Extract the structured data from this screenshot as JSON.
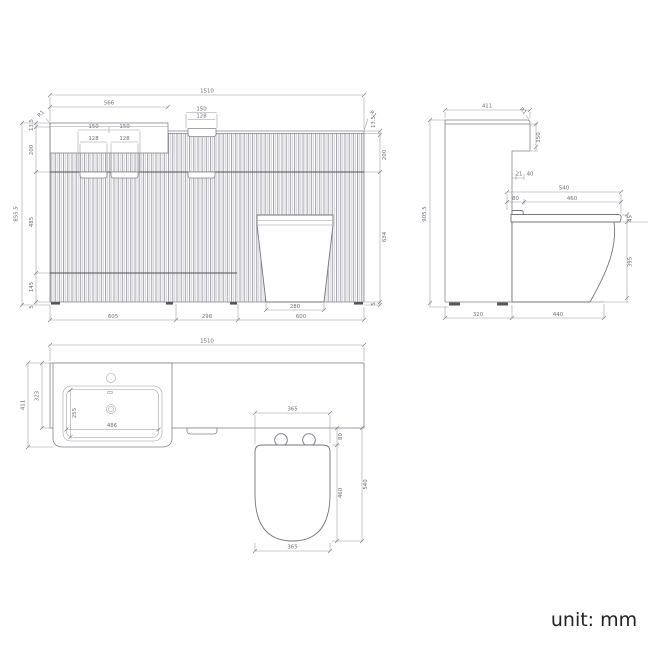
{
  "footer": {
    "unit_label": "unit: mm"
  },
  "colors": {
    "line": "#84848c",
    "dim_text": "#6e6e78",
    "unit_text": "#1f1f24",
    "background": "#ffffff"
  },
  "front": {
    "width_total": "1510",
    "basin_section_width": "566",
    "top_handle_outer": "150",
    "top_handle_inner": "128",
    "drawer_handle_left_outer": "150",
    "drawer_handle_right_outer": "150",
    "drawer_handle_left_inner": "128",
    "drawer_handle_right_inner": "128",
    "radius_left": "R1",
    "radius_right": "R1",
    "counter_thickness_left": "13.5",
    "counter_thickness_right": "13.5",
    "top_section_left": "200",
    "top_section_right": "200",
    "mid_section_left": "485",
    "lower_section_left": "145",
    "plinth_left": "5",
    "plinth_right": "5",
    "height_total": "855.5",
    "right_lower_section": "634",
    "bottom_vanity_width": "605",
    "bottom_mid_width": "298",
    "toilet_base_width": "280",
    "bottom_toilet_section": "600",
    "bottom_width_total": "1510"
  },
  "side": {
    "top_depth": "411",
    "radius": "R1",
    "counter_drop": "150",
    "gap_small": "21",
    "gap_large": "40",
    "seat_total": "540",
    "seat_back_offset": "80",
    "seat_length": "460",
    "seat_thickness": "45",
    "bowl_height": "395",
    "height_total": "905.5",
    "cabinet_depth": "320",
    "toilet_projection": "440"
  },
  "plan": {
    "left_depth": "411",
    "counter_depth": "323",
    "basin_width": "486",
    "basin_depth": "255",
    "seat_width_top": "365",
    "seat_width_bottom": "365",
    "seat_back_offset": "80",
    "seat_length": "460",
    "seat_total": "540"
  }
}
